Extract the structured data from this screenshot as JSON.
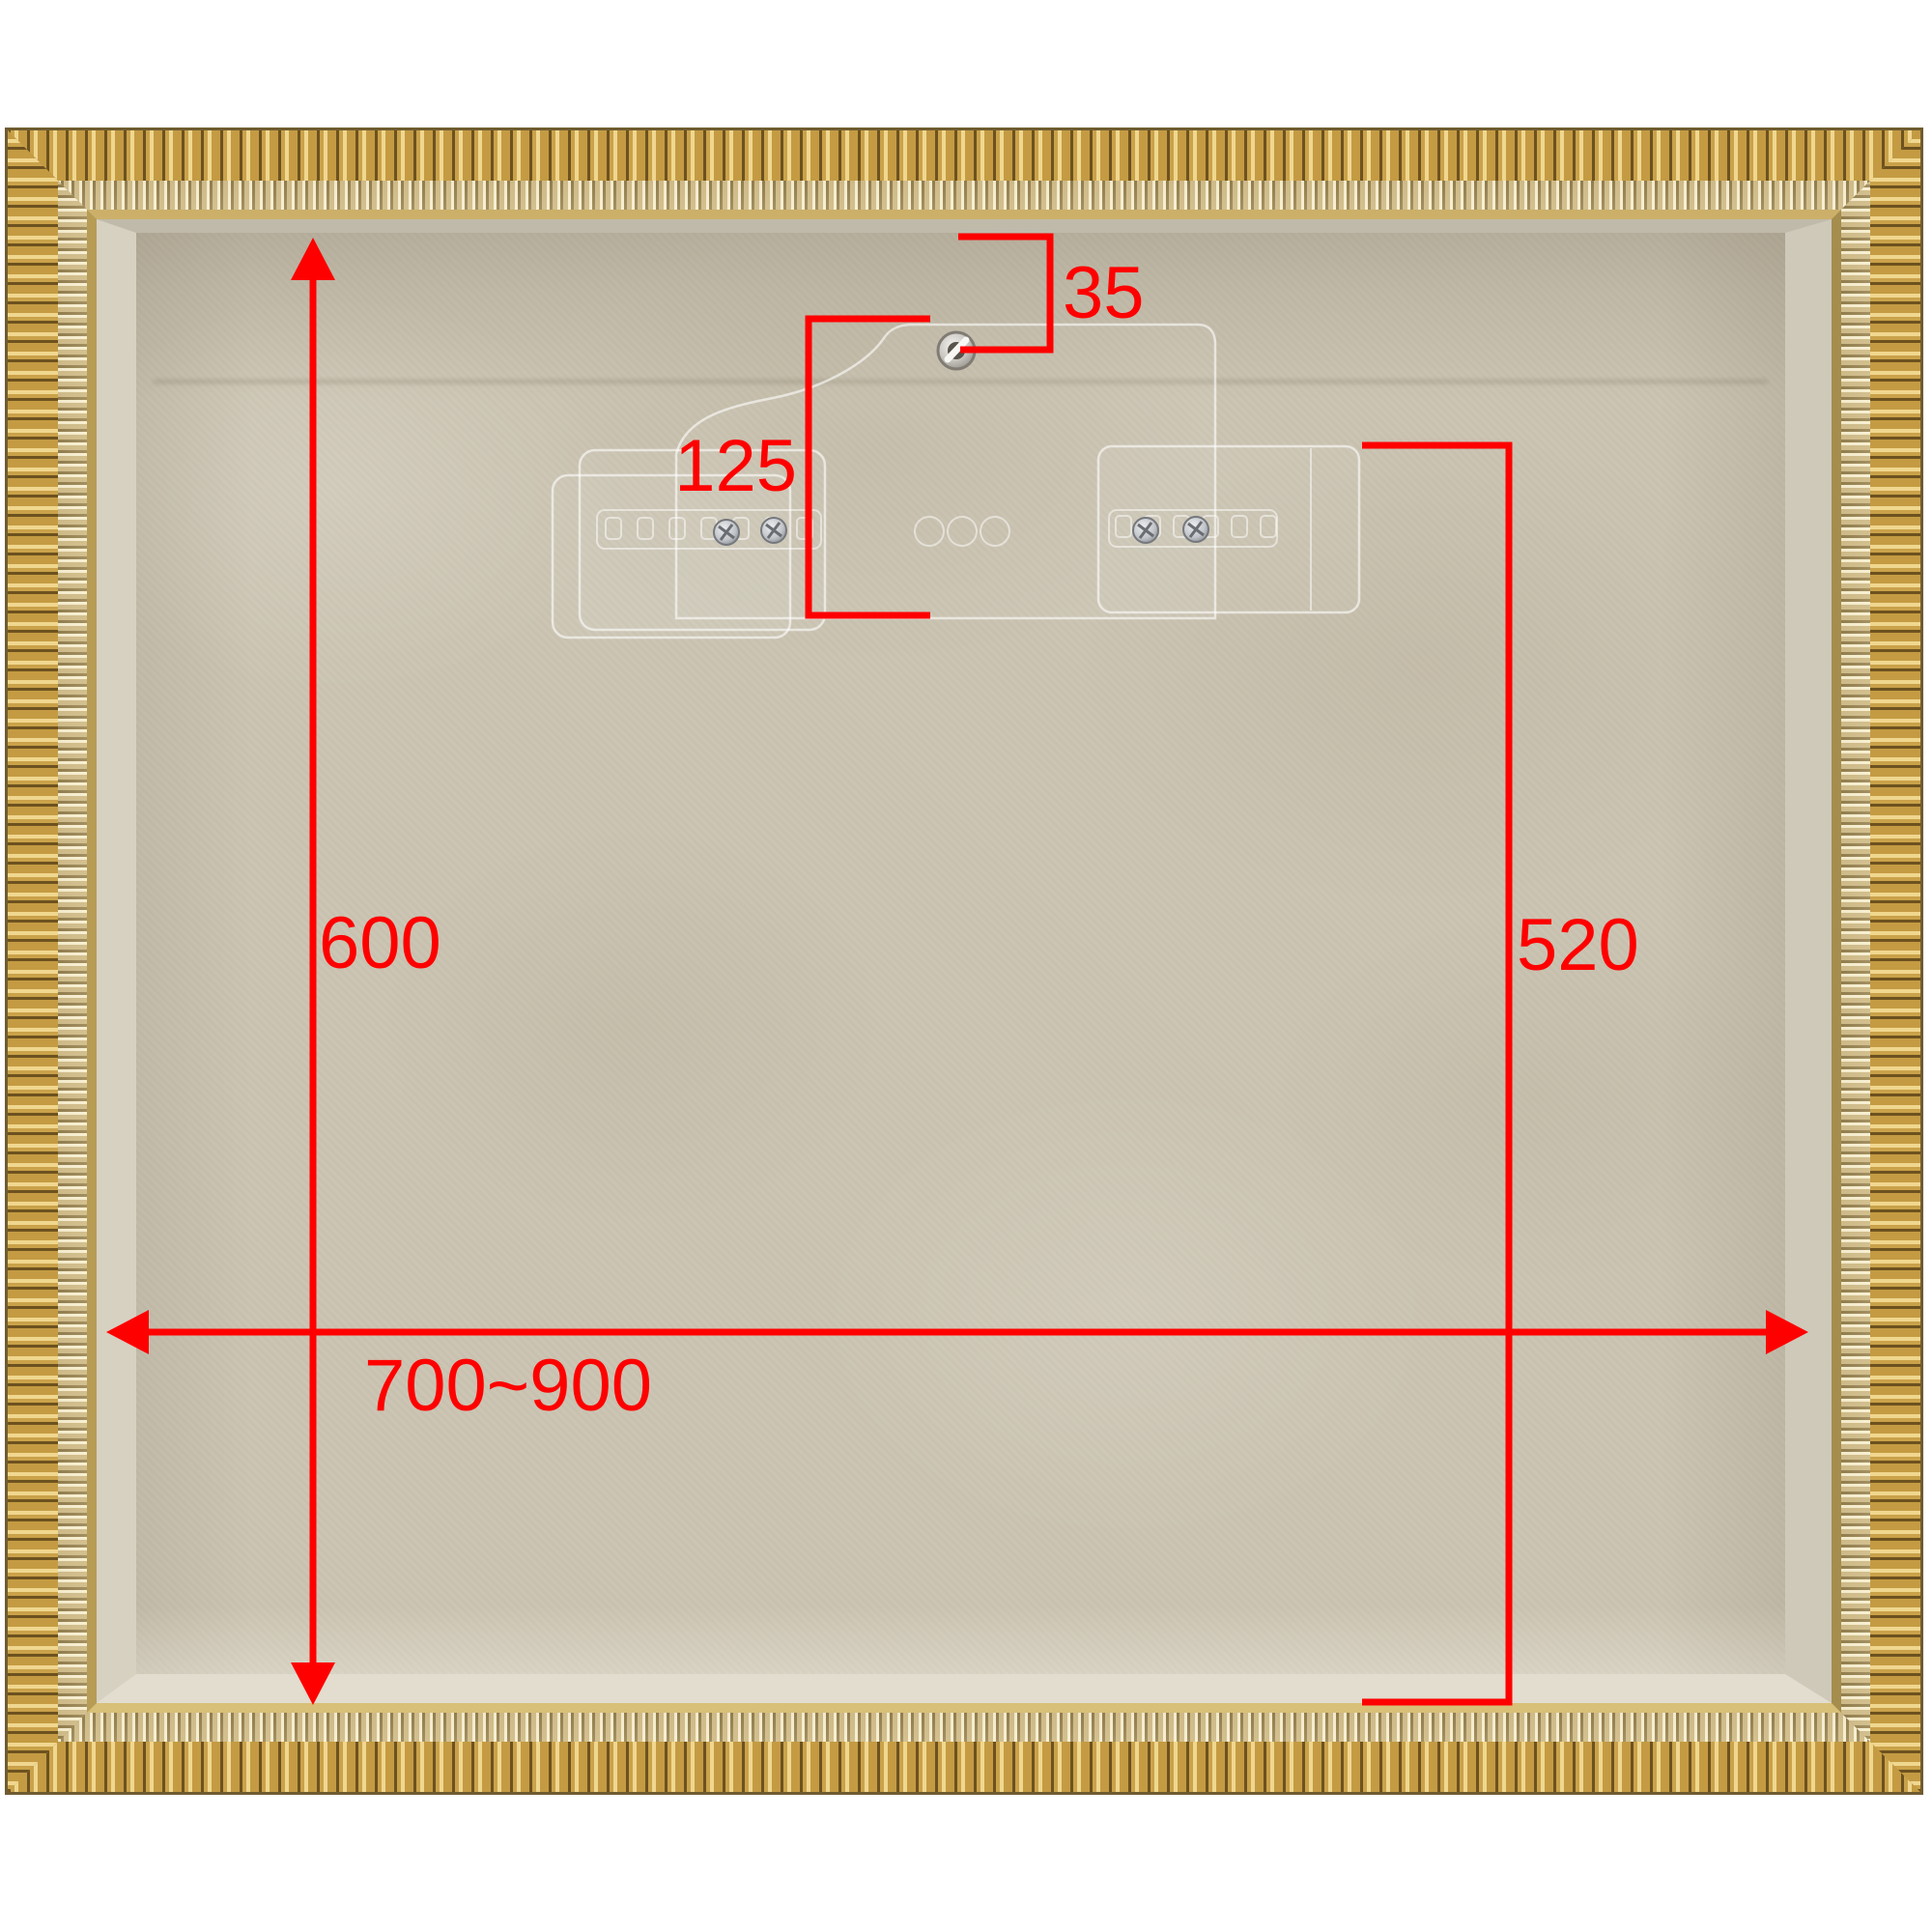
{
  "annotations": {
    "color": "#ff0000",
    "labels": {
      "frame_top_to_hole": "35",
      "hanger_plate_drop": "125",
      "opening_height": "600",
      "hanger_to_bottom": "520",
      "opening_width_range": "700~900"
    }
  },
  "palette": {
    "background": "#ffffff",
    "frame_gold": "#b8923f",
    "frame_gold_highlight": "#f0d78f",
    "frame_gold_shadow": "#6d521f",
    "bead_gold": "#c4b07a",
    "fabric": "#cbc4b2",
    "metal_hardware": "#c9c6c0"
  }
}
